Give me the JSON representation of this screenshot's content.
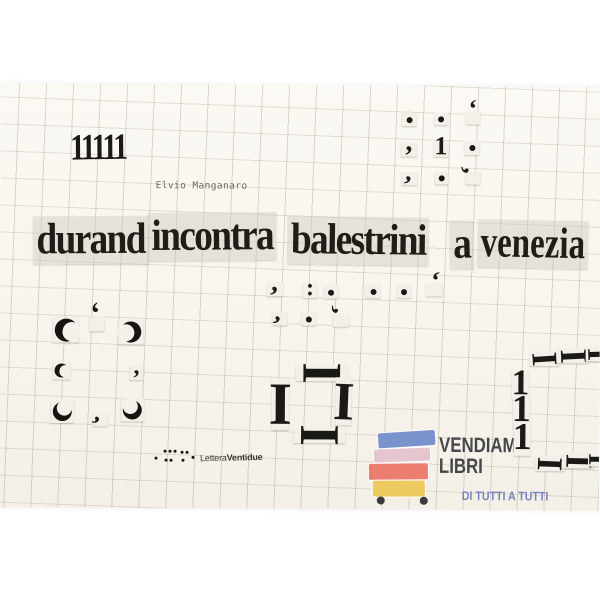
{
  "artwork": {
    "ones": "11111",
    "author": "Elvio Manganaro",
    "title_words": [
      "durand",
      "incontra",
      "balestrini",
      "a",
      "venezia"
    ],
    "publisher_regular": "Lettera",
    "publisher_bold": "Ventidue"
  },
  "watermark": {
    "line1": "VENDIAMO",
    "line2": "LIBRI",
    "tagline": "DI TUTTI A TUTTI",
    "text_color": "#45474b",
    "tagline_color": "#7583bd",
    "book_colors": [
      "#7b93cc",
      "#e5c6cf",
      "#ec7e70",
      "#ecca60"
    ],
    "wheel_color": "#3a3a3a"
  },
  "palette": {
    "page_bg": "#ffffff",
    "cover_bg": "#f8f5ee",
    "grid_line": "#c9c3b2",
    "ink": "#1b1916",
    "scrap": "#f2f0e9"
  },
  "collage": {
    "groups": [
      {
        "name": "top-right-grid",
        "items": [
          {
            "t": "dot",
            "x": 408,
            "y": 119,
            "d": 6,
            "sc": [
              15,
              13
            ]
          },
          {
            "t": "dot",
            "x": 440,
            "y": 118,
            "d": 6,
            "sc": [
              14,
              13
            ]
          },
          {
            "t": "comma",
            "x": 472,
            "y": 117,
            "fs": 26,
            "r": 180,
            "sc": [
              15,
              13
            ]
          },
          {
            "t": "comma",
            "x": 408,
            "y": 149,
            "fs": 28,
            "r": 0,
            "sc": [
              16,
              14
            ]
          },
          {
            "t": "one",
            "x": 440,
            "y": 148,
            "fs": 26,
            "sc": [
              14,
              16
            ]
          },
          {
            "t": "dot",
            "x": 471,
            "y": 147,
            "d": 6,
            "sc": [
              15,
              14
            ]
          },
          {
            "t": "comma",
            "x": 409,
            "y": 178,
            "fs": 26,
            "r": 15,
            "sc": [
              16,
              13
            ]
          },
          {
            "t": "dot",
            "x": 441,
            "y": 177,
            "d": 6,
            "sc": [
              14,
              13
            ]
          },
          {
            "t": "comma",
            "x": 472,
            "y": 177,
            "fs": 26,
            "r": 100,
            "sc": [
              15,
              13
            ]
          }
        ]
      },
      {
        "name": "mid-row-1",
        "items": [
          {
            "t": "comma",
            "x": 275,
            "y": 290,
            "fs": 28,
            "r": 10,
            "sc": [
              16,
              13
            ]
          },
          {
            "t": "colon",
            "x": 310,
            "y": 291,
            "fs": 24,
            "sc": [
              14,
              14
            ]
          },
          {
            "t": "dot",
            "x": 331,
            "y": 292,
            "d": 6,
            "sc": [
              14,
              13
            ]
          },
          {
            "t": "dot",
            "x": 373,
            "y": 291,
            "d": 6,
            "sc": [
              15,
              13
            ]
          },
          {
            "t": "dot",
            "x": 404,
            "y": 291,
            "d": 6,
            "sc": [
              14,
              13
            ]
          },
          {
            "t": "comma",
            "x": 434,
            "y": 289,
            "fs": 26,
            "r": 190,
            "sc": [
              16,
              13
            ]
          }
        ]
      },
      {
        "name": "mid-row-2",
        "items": [
          {
            "t": "comma",
            "x": 280,
            "y": 319,
            "fs": 26,
            "r": 20,
            "sc": [
              15,
              13
            ]
          },
          {
            "t": "dot",
            "x": 309,
            "y": 319,
            "d": 6,
            "sc": [
              14,
              13
            ]
          },
          {
            "t": "comma",
            "x": 341,
            "y": 320,
            "fs": 26,
            "r": 120,
            "sc": [
              16,
              13
            ]
          }
        ]
      },
      {
        "name": "left-ring",
        "items": [
          {
            "t": "cres",
            "x": 66,
            "y": 331,
            "s": 23,
            "r": 15,
            "sc": [
              26,
              26
            ]
          },
          {
            "t": "comma",
            "x": 97,
            "y": 325,
            "fs": 30,
            "r": 165,
            "sc": [
              15,
              15
            ]
          },
          {
            "t": "cres",
            "x": 131,
            "y": 333,
            "s": 21,
            "r": 170,
            "sc": [
              25,
              25
            ]
          },
          {
            "t": "cres",
            "x": 62,
            "y": 372,
            "s": 14,
            "r": 10,
            "sc": [
              18,
              18
            ]
          },
          {
            "t": "comma",
            "x": 137,
            "y": 374,
            "fs": 24,
            "r": 0,
            "sc": [
              14,
              14
            ]
          },
          {
            "t": "cres",
            "x": 63,
            "y": 413,
            "s": 19,
            "r": -60,
            "sc": [
              23,
              23
            ]
          },
          {
            "t": "comma",
            "x": 101,
            "y": 421,
            "fs": 26,
            "r": 30,
            "sc": [
              15,
              13
            ]
          },
          {
            "t": "cres",
            "x": 133,
            "y": 411,
            "s": 19,
            "r": -120,
            "sc": [
              23,
              23
            ]
          }
        ]
      },
      {
        "name": "center-frame",
        "items": [
          {
            "t": "ibeam",
            "x": 322,
            "y": 373,
            "fs": 56,
            "r": 90,
            "sc": [
              52,
              16
            ]
          },
          {
            "t": "ibeam",
            "x": 281,
            "y": 404,
            "fs": 60,
            "r": 0,
            "sc": [
              17,
              52
            ]
          },
          {
            "t": "ibeam",
            "x": 344,
            "y": 401,
            "fs": 54,
            "r": 2,
            "sc": [
              16,
              48
            ]
          },
          {
            "t": "ibeam",
            "x": 320,
            "y": 435,
            "fs": 56,
            "r": 90,
            "sc": [
              52,
              16
            ]
          }
        ]
      },
      {
        "name": "right-frame",
        "items": [
          {
            "t": "ibeam",
            "x": 545,
            "y": 357,
            "fs": 36,
            "r": 86,
            "sc": [
              30,
              15
            ]
          },
          {
            "t": "ibeam",
            "x": 573,
            "y": 354,
            "fs": 38,
            "r": 87,
            "sc": [
              32,
              15
            ]
          },
          {
            "t": "ibeam",
            "x": 599,
            "y": 352,
            "fs": 34,
            "r": 88,
            "sc": [
              26,
              15
            ]
          },
          {
            "t": "one",
            "x": 521,
            "y": 384,
            "fs": 36,
            "sc": [
              17,
              29
            ]
          },
          {
            "t": "one",
            "x": 522,
            "y": 411,
            "fs": 38,
            "sc": [
              17,
              31
            ]
          },
          {
            "t": "one",
            "x": 523,
            "y": 439,
            "fs": 38,
            "sc": [
              17,
              31
            ]
          },
          {
            "t": "ibeam",
            "x": 551,
            "y": 462,
            "fs": 36,
            "r": 92,
            "sc": [
              30,
              15
            ]
          },
          {
            "t": "ibeam",
            "x": 579,
            "y": 459,
            "fs": 38,
            "r": 91,
            "sc": [
              32,
              15
            ]
          },
          {
            "t": "ibeam",
            "x": 601,
            "y": 457,
            "fs": 32,
            "r": 90,
            "sc": [
              24,
              15
            ]
          }
        ]
      },
      {
        "name": "publisher-logo-dots",
        "items": [
          {
            "t": "dot",
            "x": 157,
            "y": 459,
            "d": 3
          },
          {
            "t": "dot",
            "x": 166,
            "y": 452,
            "d": 3
          },
          {
            "t": "dot",
            "x": 171,
            "y": 452,
            "d": 3
          },
          {
            "t": "dot",
            "x": 176,
            "y": 452,
            "d": 3
          },
          {
            "t": "dot",
            "x": 167,
            "y": 461,
            "d": 3
          },
          {
            "t": "dot",
            "x": 172,
            "y": 461,
            "d": 3
          },
          {
            "t": "dot",
            "x": 183,
            "y": 453,
            "d": 3
          },
          {
            "t": "dot",
            "x": 188,
            "y": 453,
            "d": 3
          },
          {
            "t": "dot",
            "x": 184,
            "y": 461,
            "d": 3
          },
          {
            "t": "dot",
            "x": 194,
            "y": 458,
            "d": 3
          }
        ]
      }
    ]
  }
}
